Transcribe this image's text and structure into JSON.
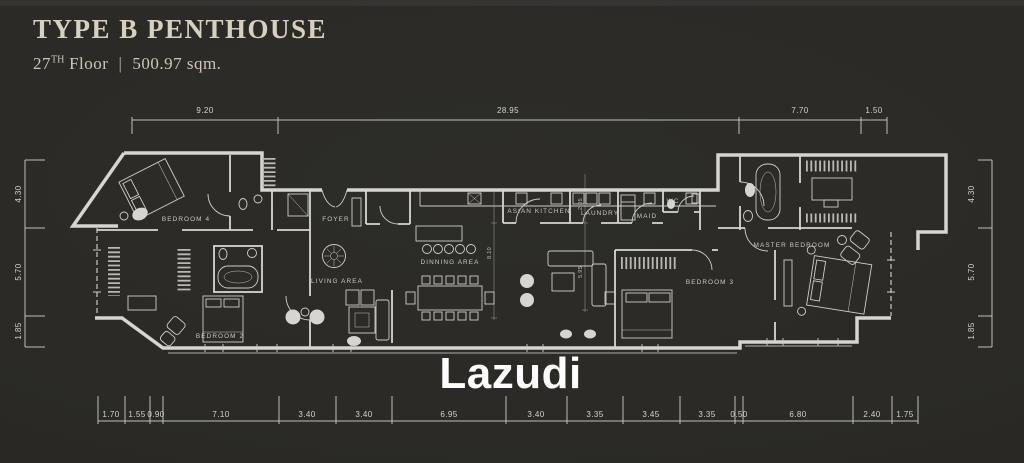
{
  "header": {
    "title": "TYPE B PENTHOUSE",
    "floor_number": "27",
    "floor_ordinal": "TH",
    "floor_word": "Floor",
    "divider": "|",
    "area": "500.97 sqm."
  },
  "watermark": "Lazudi",
  "rooms": {
    "bedroom4": {
      "label": "BEDROOM 4"
    },
    "bedroom2": {
      "label": "BEDROOM 2"
    },
    "foyer": {
      "label": "FOYER"
    },
    "living": {
      "label": "LIVING AREA"
    },
    "dining": {
      "label": "DINNING AREA"
    },
    "kitchen": {
      "label": "ASIAN KITCHEN"
    },
    "laundry": {
      "label": "LAUNDRY"
    },
    "maid": {
      "label": "MAID"
    },
    "wc": {
      "label": "WC"
    },
    "bedroom3": {
      "label": "BEDROOM 3"
    },
    "master": {
      "label": "MASTER BEDROOM"
    }
  },
  "dimensions": {
    "top": [
      "9.20",
      "28.95",
      "7.70",
      "1.50"
    ],
    "bottom": [
      "1.70",
      "1.55",
      "0.90",
      "7.10",
      "3.40",
      "3.40",
      "6.95",
      "3.40",
      "3.35",
      "3.45",
      "3.35",
      "0.50",
      "6.80",
      "2.40",
      "1.75"
    ],
    "left": [
      "4.30",
      "5.70",
      "1.85"
    ],
    "right": [
      "4.30",
      "5.70",
      "1.85"
    ],
    "interior": [
      "8.10",
      "2.05",
      "5.95"
    ]
  },
  "colors": {
    "background": "#2b2a26",
    "plan_lines": "#d6d5d1",
    "title_text": "#d7d0bf",
    "watermark_text": "#ffffff"
  }
}
